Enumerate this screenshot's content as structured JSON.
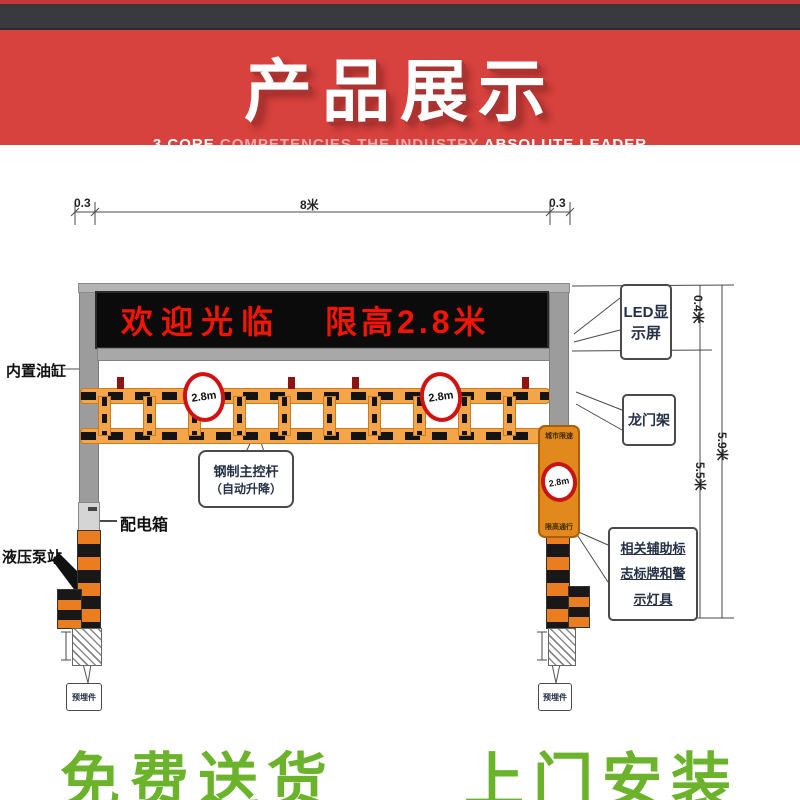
{
  "header": {
    "title": "产品展示",
    "subtitle": {
      "p1": "3 CORE ",
      "p2": "COMPETENCIES  ",
      "p3": "THE INDUSTRY ",
      "p4": "ABSOLUTE LEADER"
    }
  },
  "led": {
    "welcome": "欢迎光临",
    "limit": "限高2.8米"
  },
  "dims": {
    "top_left": "0.3",
    "top_span": "8米",
    "top_right": "0.3",
    "led_height": "0.4米",
    "total_height": "5.9米",
    "clear_height": "5.5米"
  },
  "labels": {
    "oil_cylinder": "内置油缸",
    "led_screen_l1": "LED显",
    "led_screen_l2": "示屏",
    "gantry": "龙门架",
    "control_l1": "钢制主控杆",
    "control_l2": "（自动升降）",
    "power_box": "配电箱",
    "pump_station": "液压泵站",
    "aux_l1": "相关辅助标",
    "aux_l2": "志标牌和警",
    "aux_l3": "示灯具",
    "embed": "预埋件"
  },
  "sign": {
    "top": "城市限速",
    "limit": "2.8m",
    "bottom": "限高通行"
  },
  "barrier": {
    "circle_text": "2.8m"
  },
  "footer": {
    "left": "免费送货",
    "right": "上门安装"
  },
  "colors": {
    "banner": "#d8423e",
    "led_text": "#f21505",
    "green": "#6ab32b",
    "stripe_orange": "#ea7d1f"
  }
}
